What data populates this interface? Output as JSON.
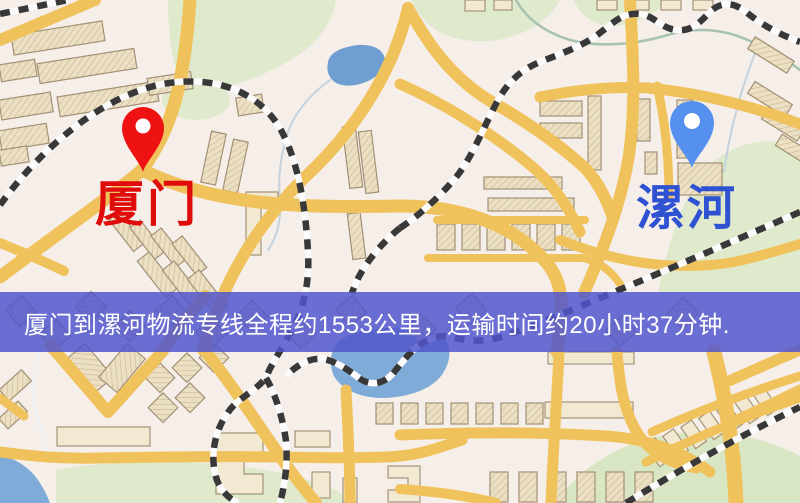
{
  "map_image": {
    "origin_marker": {
      "label": "厦门"
    },
    "destination_marker": {
      "label": "漯河"
    },
    "info_banner": {
      "text": "厦门到漯河物流专线全程约1553公里，运输时间约20小时37分钟."
    },
    "colors": {
      "origin_pin": "#ee1212",
      "origin_label": "#e00c0c",
      "destination_pin": "#5590ee",
      "destination_label": "#2f52d3",
      "banner_background": "#5156cc",
      "banner_text": "#ffffff",
      "road": "#f0c25c",
      "water": "#78a5d6",
      "park": "#dfeacc",
      "railway": "#383838",
      "background": "#f6eee9"
    }
  }
}
